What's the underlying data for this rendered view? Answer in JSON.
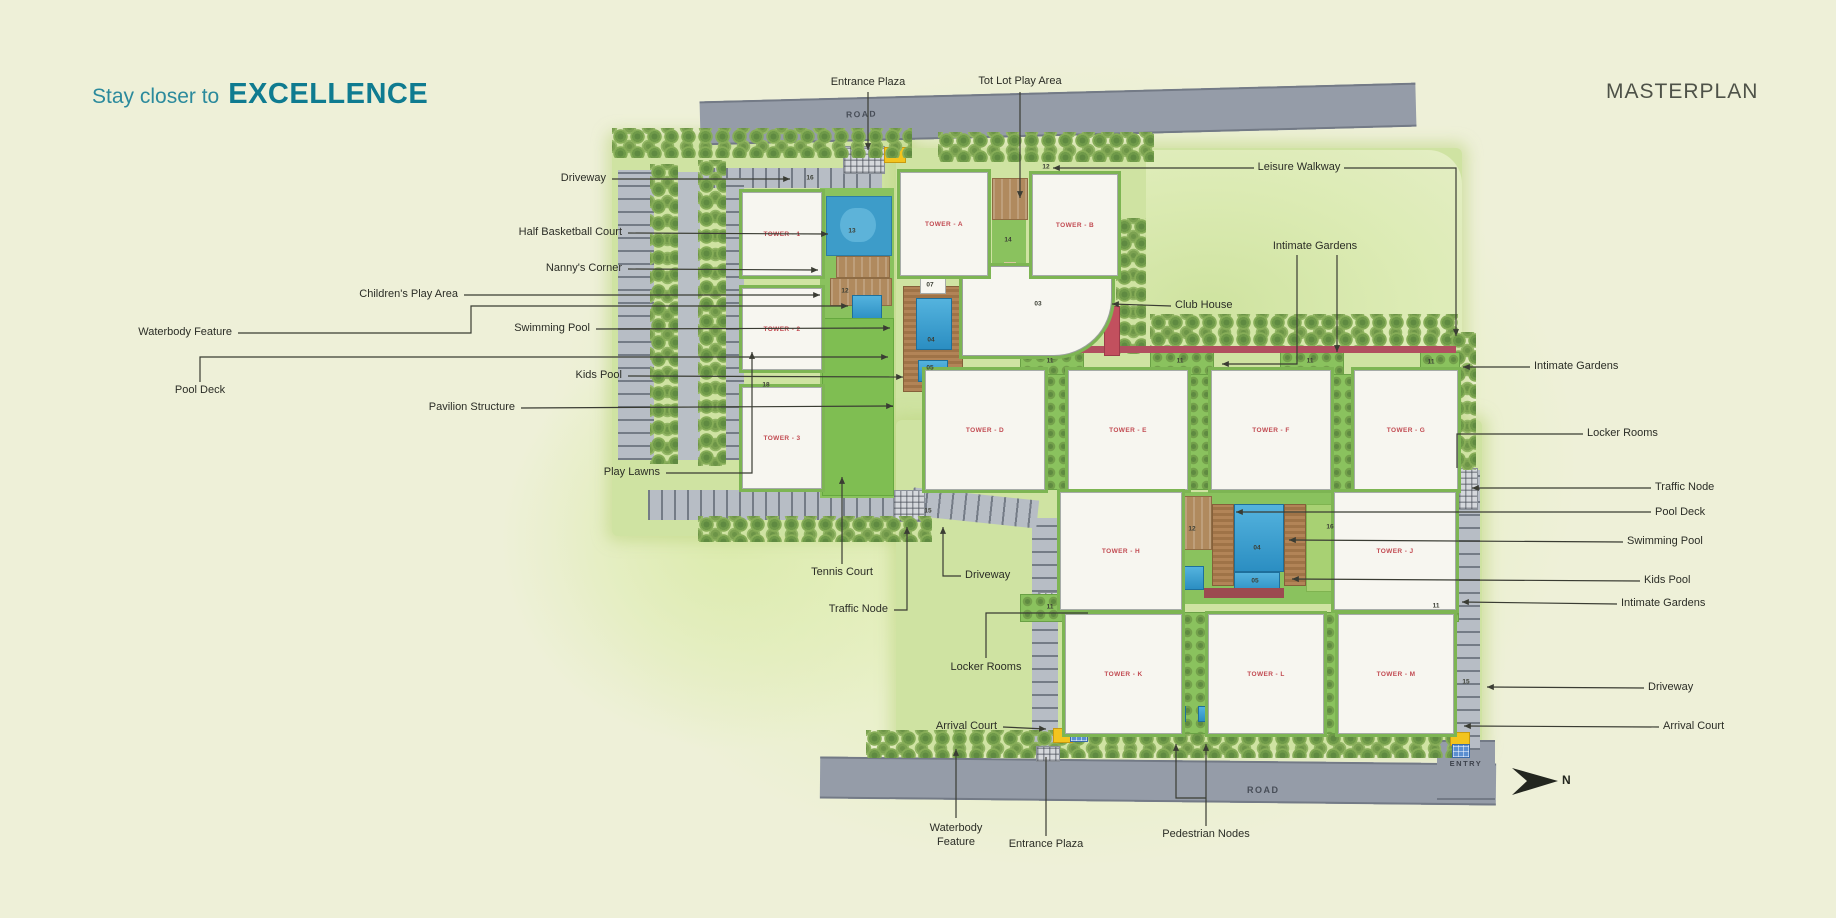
{
  "header": {
    "tagline_prefix": "Stay closer to",
    "tagline_emphasis": "EXCELLENCE",
    "title": "MASTERPLAN"
  },
  "plan": {
    "road_top": "ROAD",
    "road_bottom": "ROAD",
    "entry": "ENTRY",
    "north": "N",
    "towers": [
      {
        "id": "t1",
        "label": "TOWER - 1"
      },
      {
        "id": "t2",
        "label": "TOWER - 2"
      },
      {
        "id": "t3",
        "label": "TOWER - 3"
      },
      {
        "id": "tA",
        "label": "TOWER - A"
      },
      {
        "id": "tB",
        "label": "TOWER - B"
      },
      {
        "id": "tD",
        "label": "TOWER - D"
      },
      {
        "id": "tE",
        "label": "TOWER - E"
      },
      {
        "id": "tF",
        "label": "TOWER - F"
      },
      {
        "id": "tG",
        "label": "TOWER - G"
      },
      {
        "id": "tH",
        "label": "TOWER - H"
      },
      {
        "id": "tJ",
        "label": "TOWER - J"
      },
      {
        "id": "tK",
        "label": "TOWER - K"
      },
      {
        "id": "tL",
        "label": "TOWER - L"
      },
      {
        "id": "tM",
        "label": "TOWER - M"
      }
    ],
    "callouts": [
      {
        "id": "entrance-plaza-top",
        "text": "Entrance Plaza"
      },
      {
        "id": "tot-lot-play-area",
        "text": "Tot Lot Play Area"
      },
      {
        "id": "leisure-walkway",
        "text": "Leisure Walkway"
      },
      {
        "id": "driveway-left",
        "text": "Driveway"
      },
      {
        "id": "half-basketball-court",
        "text": "Half Basketball Court"
      },
      {
        "id": "nannys-corner",
        "text": "Nanny's Corner"
      },
      {
        "id": "childrens-play-area",
        "text": "Children's Play Area"
      },
      {
        "id": "waterbody-feature-left",
        "text": "Waterbody Feature"
      },
      {
        "id": "swimming-pool-left",
        "text": "Swimming Pool"
      },
      {
        "id": "pool-deck-left",
        "text": "Pool Deck"
      },
      {
        "id": "kids-pool-left",
        "text": "Kids Pool"
      },
      {
        "id": "pavilion-structure",
        "text": "Pavilion Structure"
      },
      {
        "id": "play-lawns",
        "text": "Play Lawns"
      },
      {
        "id": "tennis-court",
        "text": "Tennis Court"
      },
      {
        "id": "traffic-node-bottom",
        "text": "Traffic Node"
      },
      {
        "id": "driveway-bottom",
        "text": "Driveway"
      },
      {
        "id": "locker-rooms-bottom",
        "text": "Locker Rooms"
      },
      {
        "id": "arrival-court-left",
        "text": "Arrival Court"
      },
      {
        "id": "waterbody-feature-bottom",
        "text": "Waterbody Feature"
      },
      {
        "id": "entrance-plaza-bottom",
        "text": "Entrance Plaza"
      },
      {
        "id": "pedestrian-nodes",
        "text": "Pedestrian Nodes"
      },
      {
        "id": "club-house",
        "text": "Club House"
      },
      {
        "id": "intimate-gardens-top",
        "text": "Intimate Gardens"
      },
      {
        "id": "intimate-gardens-right-1",
        "text": "Intimate Gardens"
      },
      {
        "id": "locker-rooms-right",
        "text": "Locker Rooms"
      },
      {
        "id": "traffic-node-right",
        "text": "Traffic Node"
      },
      {
        "id": "pool-deck-right",
        "text": "Pool Deck"
      },
      {
        "id": "swimming-pool-right",
        "text": "Swimming Pool"
      },
      {
        "id": "kids-pool-right",
        "text": "Kids Pool"
      },
      {
        "id": "intimate-gardens-right-2",
        "text": "Intimate Gardens"
      },
      {
        "id": "driveway-right",
        "text": "Driveway"
      },
      {
        "id": "arrival-court-right",
        "text": "Arrival Court"
      }
    ],
    "markers": [
      {
        "id": "m16a",
        "value": "16"
      },
      {
        "id": "m13",
        "value": "13"
      },
      {
        "id": "m12a",
        "value": "12"
      },
      {
        "id": "m18",
        "value": "18"
      },
      {
        "id": "m15a",
        "value": "15"
      },
      {
        "id": "m14",
        "value": "14"
      },
      {
        "id": "m07",
        "value": "07"
      },
      {
        "id": "m03",
        "value": "03"
      },
      {
        "id": "m04a",
        "value": "04"
      },
      {
        "id": "m05a",
        "value": "05"
      },
      {
        "id": "m12w",
        "value": "12"
      },
      {
        "id": "m11a",
        "value": "11"
      },
      {
        "id": "m11b",
        "value": "11"
      },
      {
        "id": "m11c",
        "value": "11"
      },
      {
        "id": "m11d",
        "value": "11"
      },
      {
        "id": "m11e",
        "value": "11"
      },
      {
        "id": "m11f",
        "value": "11"
      },
      {
        "id": "m12p",
        "value": "12"
      },
      {
        "id": "m04b",
        "value": "04"
      },
      {
        "id": "m05b",
        "value": "05"
      },
      {
        "id": "m16b",
        "value": "16"
      },
      {
        "id": "m15b",
        "value": "15"
      }
    ]
  },
  "colors": {
    "accent_teal": "#0f7b90",
    "title_gray": "#4e5248",
    "label_ink": "#2b2d26",
    "road_gray": "#959ca8",
    "tree_green": "#6f9a49",
    "lawn_green": "#7fbe52",
    "pool_blue": "#3ba1d2",
    "deck_brown": "#aa8054",
    "marker_yellow": "#f3c41e",
    "tower_label_red": "#c24b52"
  }
}
